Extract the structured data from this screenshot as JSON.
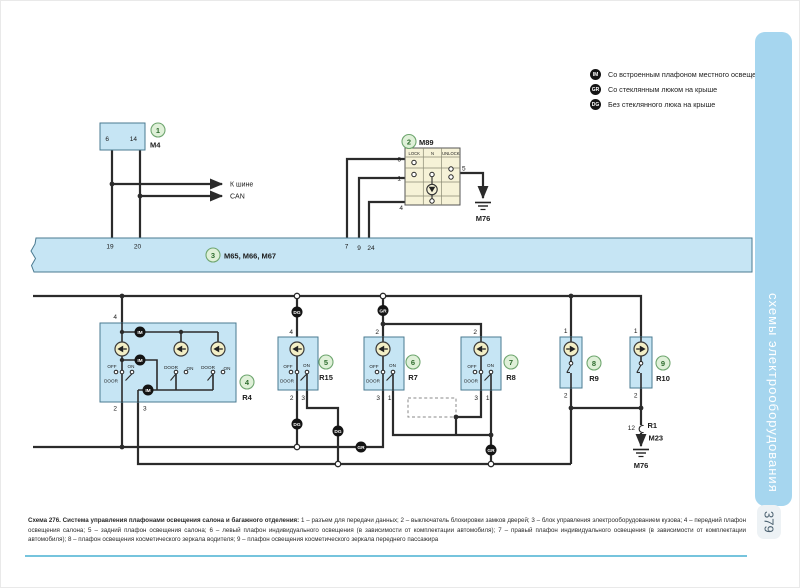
{
  "page": {
    "number": "379"
  },
  "sidebar": {
    "tab_label": "схемы электрооборудования"
  },
  "legend": {
    "items": [
      {
        "badge": "IM",
        "text": "Со встроенным плафоном местного освещения"
      },
      {
        "badge": "GR",
        "text": "Со стеклянным люком на крыше"
      },
      {
        "badge": "DG",
        "text": "Без стеклянного люка на крыше"
      }
    ]
  },
  "caption": {
    "lead": "Схема 276. Система управления плафонами освещения салона и багажного отделения:",
    "body": " 1 – разъем для передачи данных; 2 – выключатель блокировки замков дверей; 3 – блок управления электрооборудованием кузова; 4 – передний плафон освещения салона; 5 – задний плафон освещения салона; 6 – левый плафон индивидуального освещения (в зависимости от комплектации автомобиля); 7 – правый плафон индивидуального освещения (в зависимости от комплектации автомобиля); 8 – плафон освещения косметического зеркала водителя; 9 – плафон освещения косметического зеркала переднего пассажира"
  },
  "diagram": {
    "badge_im": "IM",
    "badge_gr": "GR",
    "badge_dg": "DG",
    "m4": {
      "num": "1",
      "ref": "M4",
      "pin6": "6",
      "pin14": "14"
    },
    "can": {
      "line1": "К шине",
      "line2": "CAN"
    },
    "bus": {
      "num": "3",
      "ref": "M65, M66, M67",
      "p19": "19",
      "p20": "20",
      "p7": "7",
      "p9": "9",
      "p24": "24"
    },
    "m89": {
      "num": "2",
      "ref": "M89",
      "col_lock": "LOCK",
      "col_n": "N",
      "col_unlock": "UNLOCK",
      "p6": "6",
      "p1": "1",
      "p5": "5",
      "p4": "4",
      "gnd": "M76"
    },
    "r4": {
      "num": "4",
      "ref": "R4",
      "p4": "4",
      "p2": "2",
      "p3": "3",
      "off": "OFF",
      "on": "ON",
      "door": "DOOR"
    },
    "r15": {
      "num": "5",
      "ref": "R15",
      "pt": "4",
      "pl": "2",
      "pr": "3",
      "off": "OFF",
      "on": "ON",
      "door": "DOOR"
    },
    "r7": {
      "num": "6",
      "ref": "R7",
      "pt": "2",
      "pl": "3",
      "pr": "1",
      "off": "OFF",
      "on": "ON",
      "door": "DOOR"
    },
    "r8": {
      "num": "7",
      "ref": "R8",
      "pt": "2",
      "pl": "3",
      "pr": "1",
      "off": "OFF",
      "on": "ON",
      "door": "DOOR"
    },
    "r9": {
      "num": "8",
      "ref": "R9",
      "pt": "1",
      "pb": "2"
    },
    "r10": {
      "num": "9",
      "ref": "R10",
      "pt": "1",
      "pb": "2"
    },
    "r1": {
      "pin": "12",
      "ref": "R1",
      "conn": "M23",
      "gnd": "M76"
    },
    "colors": {
      "accent_blue": "#c6e5f4",
      "tab_blue": "#a6d6ef",
      "cream": "#f6f2d7",
      "rule_teal": "#76c4dd"
    }
  }
}
